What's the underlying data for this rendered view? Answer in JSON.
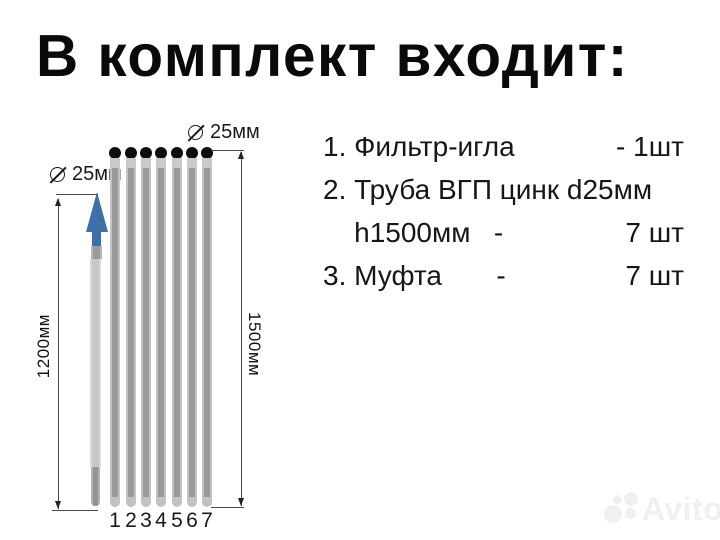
{
  "title": "В комплект входит:",
  "diagram": {
    "needle_diameter_label": "25мм",
    "pipe_diameter_label": "25мм",
    "needle_height_label": "1200мм",
    "pipe_height_label": "1500мм",
    "pipe_numbers": [
      "1",
      "2",
      "3",
      "4",
      "5",
      "6",
      "7"
    ]
  },
  "list": {
    "items": [
      {
        "left": "1. Фильтр-игла",
        "right": "- 1шт"
      },
      {
        "left": "2. Труба ВГП цинк d25мм",
        "right": ""
      },
      {
        "left": "    h1500мм   -",
        "right": "7 шт"
      },
      {
        "left": "3. Муфта       -",
        "right": "7 шт"
      }
    ]
  },
  "watermark": {
    "text": "Avito"
  },
  "colors": {
    "arrow_blue": "#3c70a8",
    "pipe_gray": "#9a9a9a",
    "pipe_edge_gray": "#c3c3c3",
    "needle_rod_gray": "#c7c7c7",
    "needle_tip_gray": "#949494",
    "pipe_top_dot": "#0d0d0d",
    "text_black": "#0a0a0a"
  }
}
